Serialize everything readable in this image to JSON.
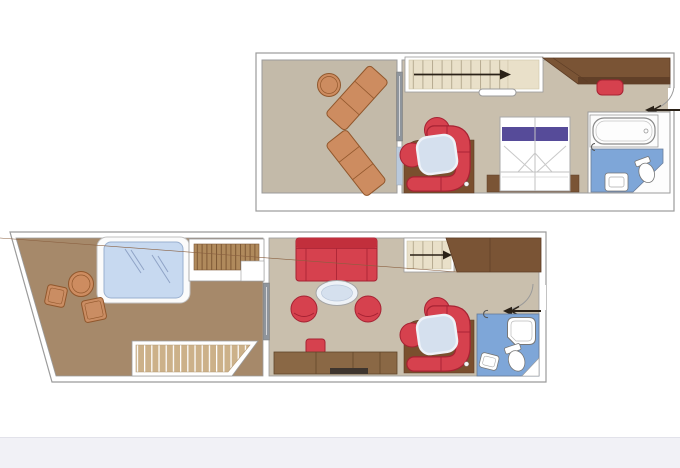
{
  "visible_text": [],
  "page": {
    "background": "#ffffff",
    "footer_band": "#f1f1f6",
    "description": "two-level duplex suite floor plan, no visible text"
  },
  "palette": {
    "wall_stroke": "#9b9b9b",
    "frame_white": "#ffffff",
    "balcony_floor": "#c3baa9",
    "interior_floor": "#c9bfad",
    "terrace_floor": "#a6896a",
    "nook_floor": "#7a4f2e",
    "furniture_brown": "#7a5435",
    "furniture_brown_dark": "#5d3d26",
    "sideboard_brown": "#8a6845",
    "red": "#d6414e",
    "red_dark": "#a62233",
    "red_back": "#c22f3c",
    "orange_wood": "#cd8c60",
    "orange_stroke": "#91572c",
    "stair_fill": "#e9e0c9",
    "stair_line": "#b6ab90",
    "deck_plank": "#b08a5c",
    "deck_plank_line": "#7d5835",
    "light_plank": "#ccb189",
    "water_blue": "#c7d9f0",
    "water_line": "#8fa3c6",
    "bath_blue": "#7ea6d8",
    "glass_gray": "#8f959c",
    "glass_blue": "#b9c9dc",
    "bed_purple": "#564b99",
    "table_glass": "#d5e0ee",
    "arrow_black": "#2a2117",
    "fixture_white": "#ffffff"
  },
  "upper_level": {
    "name": "upper-level-plan",
    "areas": [
      {
        "name": "balcony-terrace",
        "items": [
          "sun-lounger",
          "sun-lounger",
          "round-side-table",
          "sliding-glass-door"
        ]
      },
      {
        "name": "bedroom-living",
        "items": [
          "staircase-with-up-arrow",
          "wardrobe",
          "vanity-stool",
          "dining-nook-curved-sofa",
          "glass-table",
          "round-armchair",
          "round-armchair",
          "double-bed",
          "bed-platform",
          "entrance-door-with-arrow"
        ]
      },
      {
        "name": "bathroom",
        "items": [
          "bathtub",
          "toilet",
          "washbasin"
        ]
      }
    ]
  },
  "lower_level": {
    "name": "lower-level-plan",
    "areas": [
      {
        "name": "sun-terrace",
        "items": [
          "whirlpool-hot-tub",
          "round-table",
          "deck-chair",
          "deck-chair",
          "deck-plank-platform",
          "deck-plank-steps",
          "sliding-glass-door"
        ]
      },
      {
        "name": "living-room",
        "items": [
          "sofa",
          "oval-coffee-table",
          "tub-chair",
          "tub-chair",
          "ottoman",
          "sideboard",
          "dining-nook-curved-sofa",
          "glass-table",
          "round-armchair",
          "round-armchair",
          "staircase-with-up-arrow",
          "wardrobe",
          "entrance-door-with-arrow"
        ]
      },
      {
        "name": "bathroom",
        "items": [
          "shower",
          "toilet",
          "washbasin"
        ]
      }
    ]
  }
}
